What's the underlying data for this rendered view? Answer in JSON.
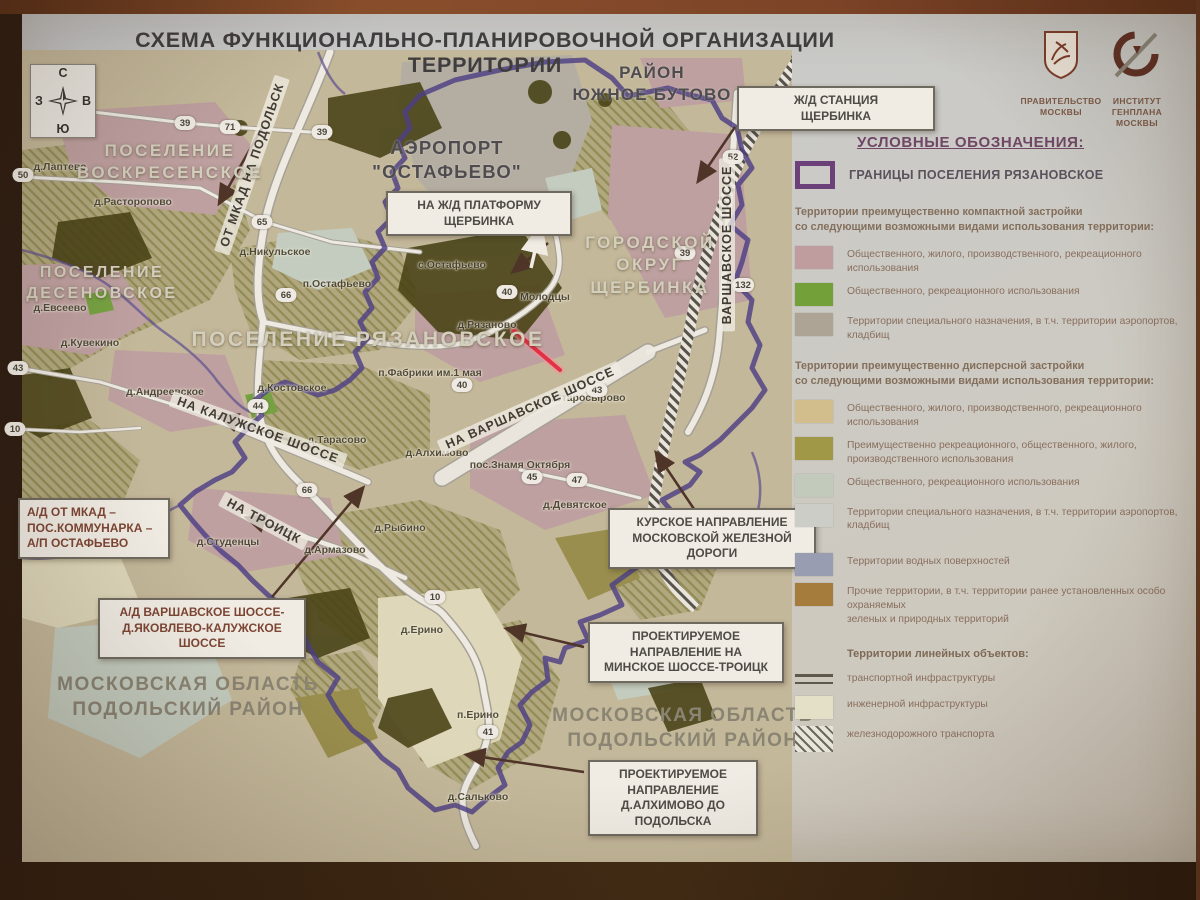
{
  "title": "СХЕМА ФУНКЦИОНАЛЬНО-ПЛАНИРОВОЧНОЙ ОРГАНИЗАЦИИ ТЕРРИТОРИИ",
  "compass": {
    "n": "С",
    "s": "Ю",
    "w": "З",
    "e": "В"
  },
  "logos": {
    "government": {
      "caption": [
        "ПРАВИТЕЛЬСТВО",
        "МОСКВЫ"
      ]
    },
    "genplan": {
      "caption": [
        "ИНСТИТУТ",
        "ГЕНПЛАНА",
        "МОСКВЫ"
      ]
    }
  },
  "map": {
    "highlight_color": "#f5243f",
    "boundary_color": "#4b3d8f",
    "area_labels": [
      {
        "lines": [
          "РАЙОН",
          "ЮЖНОЕ БУТОВО"
        ],
        "x": 652,
        "y": 62,
        "size": 17,
        "style": "dark"
      },
      {
        "lines": [
          "АЭРОПОРТ",
          "\"ОСТАФЬЕВО\""
        ],
        "x": 447,
        "y": 136,
        "size": 18.5,
        "style": "dark"
      },
      {
        "lines": [
          "ПОСЕЛЕНИЕ",
          "ВОСКРЕСЕНСКОЕ"
        ],
        "x": 170,
        "y": 140,
        "size": 17,
        "style": "light"
      },
      {
        "lines": [
          "ПОСЕЛЕНИЕ",
          "ДЕСЕНОВСКОЕ"
        ],
        "x": 102,
        "y": 262,
        "size": 16,
        "style": "light"
      },
      {
        "lines": [
          "ПОСЕЛЕНИЕ РЯЗАНОВСКОЕ"
        ],
        "x": 368,
        "y": 326,
        "size": 21,
        "style": "light"
      },
      {
        "lines": [
          "ГОРОДСКОЙ",
          "ОКРУГ",
          "ЩЕРБИНКА"
        ],
        "x": 650,
        "y": 232,
        "size": 17,
        "style": "light"
      },
      {
        "lines": [
          "МОСКОВСКАЯ ОБЛАСТЬ",
          "ПОДОЛЬСКИЙ РАЙОН"
        ],
        "x": 188,
        "y": 672,
        "size": 19,
        "style": "mid"
      },
      {
        "lines": [
          "МОСКОВСКАЯ ОБЛАСТЬ",
          "ПОДОЛЬСКИЙ РАЙОН"
        ],
        "x": 683,
        "y": 703,
        "size": 19,
        "style": "mid"
      }
    ],
    "villages": [
      {
        "text": "д.Лаптево",
        "x": 60,
        "y": 167
      },
      {
        "text": "д.Расторопово",
        "x": 133,
        "y": 202
      },
      {
        "text": "д.Евсеево",
        "x": 60,
        "y": 308
      },
      {
        "text": "д.Кувекино",
        "x": 90,
        "y": 343
      },
      {
        "text": "д.Андреевское",
        "x": 165,
        "y": 392
      },
      {
        "text": "д.Никульское",
        "x": 275,
        "y": 252
      },
      {
        "text": "п.Остафьево",
        "x": 337,
        "y": 284
      },
      {
        "text": "с.Остафьево",
        "x": 452,
        "y": 265
      },
      {
        "text": "д.Рязаново",
        "x": 487,
        "y": 325
      },
      {
        "text": "Молодцы",
        "x": 545,
        "y": 297
      },
      {
        "text": "п.Фабрики им.1 мая",
        "x": 430,
        "y": 373
      },
      {
        "text": "д.Костовское",
        "x": 292,
        "y": 388
      },
      {
        "text": "д.Тарасово",
        "x": 337,
        "y": 440
      },
      {
        "text": "д.Алхимово",
        "x": 437,
        "y": 453
      },
      {
        "text": "пос.Знамя Октября",
        "x": 520,
        "y": 465
      },
      {
        "text": "д.Старосырово",
        "x": 585,
        "y": 398
      },
      {
        "text": "д.Девятское",
        "x": 575,
        "y": 505
      },
      {
        "text": "д.Рыбино",
        "x": 400,
        "y": 528
      },
      {
        "text": "д.Студенцы",
        "x": 228,
        "y": 542
      },
      {
        "text": "д.Армазово",
        "x": 335,
        "y": 550
      },
      {
        "text": "д.Ерино",
        "x": 422,
        "y": 630
      },
      {
        "text": "п.Ерино",
        "x": 478,
        "y": 715
      },
      {
        "text": "д.Сальково",
        "x": 478,
        "y": 797
      }
    ],
    "road_labels": [
      {
        "text": "ОТ МКАД  НА ПОДОЛЬСК",
        "x": 252,
        "y": 165,
        "rotate": -71
      },
      {
        "text": "НА КАЛУЖСКОЕ ШОССЕ",
        "x": 258,
        "y": 430,
        "rotate": 20
      },
      {
        "text": "НА ТРОИЦК",
        "x": 264,
        "y": 521,
        "rotate": 28
      },
      {
        "text": "НА ВАРШАВСКОЕ ШОССЕ",
        "x": 530,
        "y": 408,
        "rotate": -24
      },
      {
        "text": "ВАРШАВСКОЕ ШОССЕ",
        "x": 727,
        "y": 245,
        "rotate": -90
      }
    ],
    "road_badges": [
      {
        "num": "39",
        "x": 185,
        "y": 123
      },
      {
        "num": "71",
        "x": 230,
        "y": 127
      },
      {
        "num": "39",
        "x": 322,
        "y": 132
      },
      {
        "num": "65",
        "x": 262,
        "y": 222
      },
      {
        "num": "66",
        "x": 286,
        "y": 295
      },
      {
        "num": "50",
        "x": 23,
        "y": 175
      },
      {
        "num": "43",
        "x": 18,
        "y": 368
      },
      {
        "num": "10",
        "x": 15,
        "y": 429
      },
      {
        "num": "44",
        "x": 258,
        "y": 406
      },
      {
        "num": "66",
        "x": 307,
        "y": 490
      },
      {
        "num": "40",
        "x": 507,
        "y": 292
      },
      {
        "num": "40",
        "x": 462,
        "y": 385
      },
      {
        "num": "43",
        "x": 597,
        "y": 390
      },
      {
        "num": "45",
        "x": 532,
        "y": 477
      },
      {
        "num": "47",
        "x": 577,
        "y": 480
      },
      {
        "num": "10",
        "x": 435,
        "y": 597
      },
      {
        "num": "41",
        "x": 488,
        "y": 732
      },
      {
        "num": "52",
        "x": 733,
        "y": 157
      },
      {
        "num": "39",
        "x": 685,
        "y": 253
      },
      {
        "num": "132",
        "x": 743,
        "y": 285
      }
    ],
    "callouts": [
      {
        "lines": [
          "Ж/Д СТАНЦИЯ",
          "ЩЕРБИНКА"
        ],
        "x": 737,
        "y": 86,
        "w": 180,
        "tone": "dark",
        "align": "center"
      },
      {
        "lines": [
          "НА Ж/Д ПЛАТФОРМУ",
          "ЩЕРБИНКА"
        ],
        "x": 386,
        "y": 191,
        "w": 168,
        "tone": "dark",
        "align": "center"
      },
      {
        "lines": [
          "А/Д ОТ МКАД –",
          "ПОС.КОММУНАРКА –",
          "А/П ОСТАФЬЕВО"
        ],
        "x": 18,
        "y": 498,
        "w": 134,
        "tone": "red",
        "align": "left"
      },
      {
        "lines": [
          "А/Д ВАРШАВСКОЕ ШОССЕ-",
          "Д.ЯКОВЛЕВО-КАЛУЖСКОЕ",
          "ШОССЕ"
        ],
        "x": 98,
        "y": 598,
        "w": 190,
        "tone": "red",
        "align": "center"
      },
      {
        "lines": [
          "КУРСКОЕ НАПРАВЛЕНИЕ",
          "МОСКОВСКОЙ ЖЕЛЕЗНОЙ",
          "ДОРОГИ"
        ],
        "x": 608,
        "y": 508,
        "w": 190,
        "tone": "dark",
        "align": "center"
      },
      {
        "lines": [
          "ПРОЕКТИРУЕМОЕ",
          "НАПРАВЛЕНИЕ НА",
          "МИНСКОЕ ШОССЕ-ТРОИЦК"
        ],
        "x": 588,
        "y": 622,
        "w": 178,
        "tone": "dark",
        "align": "center"
      },
      {
        "lines": [
          "ПРОЕКТИРУЕМОЕ",
          "НАПРАВЛЕНИЕ",
          "Д.АЛХИМОВО ДО",
          "ПОДОЛЬСКА"
        ],
        "x": 588,
        "y": 760,
        "w": 152,
        "tone": "dark",
        "align": "center"
      }
    ]
  },
  "legend": {
    "title": "УСЛОВНЫЕ ОБОЗНАЧЕНИЯ:",
    "boundary": {
      "color": "#6b3f7d",
      "label": "ГРАНИЦЫ ПОСЕЛЕНИЯ РЯЗАНОВСКОЕ"
    },
    "sections": [
      {
        "header": [
          "Территории преимущественно компактной застройки",
          "со следующими возможными видами использования территории:"
        ],
        "items": [
          {
            "color": "#c2a0a4",
            "lines": [
              "Общественного, жилого, производственного, рекреационного использования"
            ]
          },
          {
            "color": "#72a438",
            "lines": [
              "Общественного, рекреационного использования"
            ]
          },
          {
            "color": "#b0a89a",
            "lines": [
              "Территории специального назначения, в т.ч. территории аэропортов, кладбищ"
            ]
          }
        ]
      },
      {
        "header": [
          "Территории преимущественно дисперсной застройки",
          "со следующими возможными видами использования территории:"
        ],
        "items": [
          {
            "color": "#d6c392",
            "lines": [
              "Общественного, жилого, производственного, рекреационного использования"
            ]
          },
          {
            "color": "#a29a48",
            "lines": [
              "Преимущественно рекреационного, общественного, жилого,",
              "производственного использования"
            ]
          },
          {
            "color": "#c4d0c2",
            "lines": [
              "Общественного, рекреационного использования"
            ]
          },
          {
            "color": "#d1d3cf",
            "lines": [
              "Территории специального назначения, в т.ч. территории аэропортов, кладбищ"
            ]
          }
        ]
      }
    ],
    "standalone": [
      {
        "color": "#9aa1b9",
        "lines": [
          "Территории водных поверхностей"
        ],
        "gap": 20
      },
      {
        "color": "#a87e3e",
        "lines": [
          "Прочие территории, в т.ч. территории ранее установленных особо охраняемых",
          "зеленых и природных территорий"
        ],
        "gap": 6
      }
    ],
    "linear": {
      "header": "Территории линейных объектов:",
      "items": [
        {
          "type": "lines",
          "lines": [
            "транспортной инфраструктуры"
          ]
        },
        {
          "type": "swatch",
          "color": "#e9e6cf",
          "lines": [
            "инженерной инфраструктуры"
          ]
        },
        {
          "type": "hatch",
          "lines": [
            "железнодорожного транспорта"
          ]
        }
      ]
    }
  }
}
